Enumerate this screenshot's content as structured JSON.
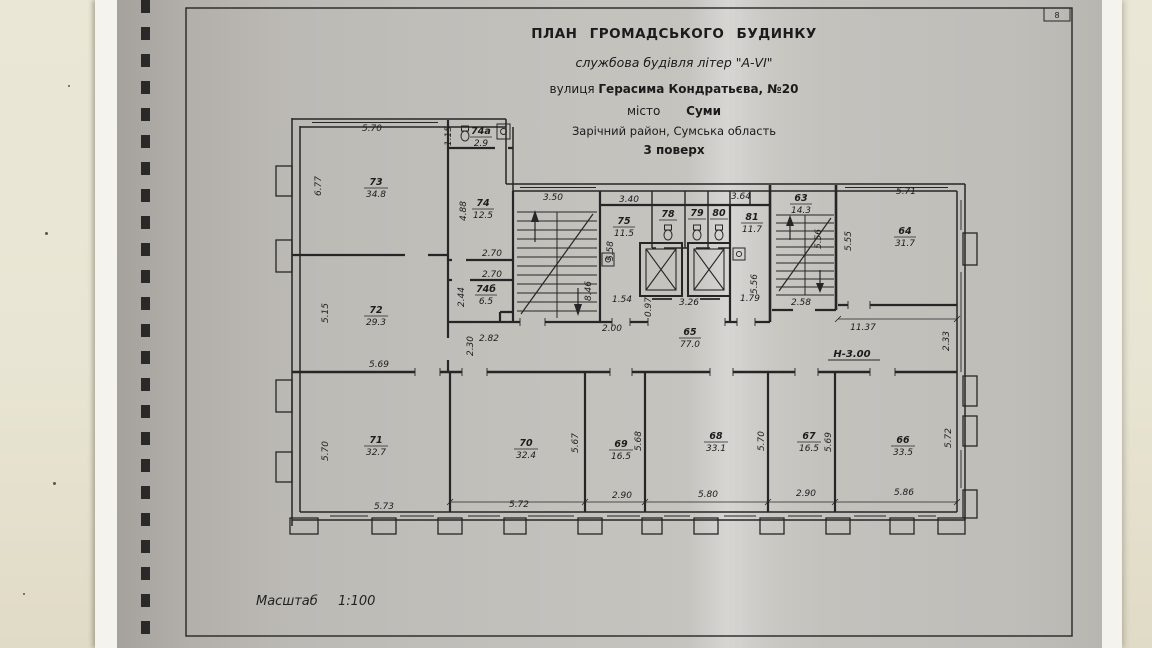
{
  "page": {
    "corner_number": "8"
  },
  "title_block": {
    "line1": "ПЛАН ГРОМАДСЬКОГО БУДИНКУ",
    "line2": "службова будівля літер \"А-VI\"",
    "line3_label": "вулиця",
    "line3_value": "Герасима Кондратьєва, №20",
    "line4_label": "місто",
    "line4_value": "Суми",
    "line5": "Зарічний район, Сумська область",
    "line6": "3 поверх"
  },
  "scale_note": {
    "label": "Масштаб",
    "value": "1:100"
  },
  "plan": {
    "height_mark": "Н-3.00",
    "rooms": [
      {
        "num": "73",
        "area": "34.8"
      },
      {
        "num": "74а",
        "area": "2.9"
      },
      {
        "num": "74",
        "area": "12.5"
      },
      {
        "num": "74б",
        "area": "6.5"
      },
      {
        "num": "72",
        "area": "29.3"
      },
      {
        "num": "75",
        "area": "11.5"
      },
      {
        "num": "78",
        "area": ""
      },
      {
        "num": "79",
        "area": ""
      },
      {
        "num": "80",
        "area": ""
      },
      {
        "num": "81",
        "area": "11.7"
      },
      {
        "num": "63",
        "area": "14.3"
      },
      {
        "num": "64",
        "area": "31.7"
      },
      {
        "num": "65",
        "area": "77.0"
      },
      {
        "num": "71",
        "area": "32.7"
      },
      {
        "num": "70",
        "area": "32.4"
      },
      {
        "num": "69",
        "area": "16.5"
      },
      {
        "num": "68",
        "area": "33.1"
      },
      {
        "num": "67",
        "area": "16.5"
      },
      {
        "num": "66",
        "area": "33.5"
      }
    ],
    "dims": [
      "5.70",
      "1.15",
      "6.77",
      "4.88",
      "2.70",
      "2.70",
      "2.44",
      "2.82",
      "5.15",
      "2.30",
      "3.50",
      "8.46",
      "3.40",
      "5.58",
      "1.54",
      "0.97",
      "3.26",
      "3.64",
      "1.79",
      "5.56",
      "5.56",
      "2.58",
      "5.55",
      "5.71",
      "2.00",
      "11.37",
      "2.33",
      "5.69",
      "5.70",
      "5.73",
      "5.72",
      "5.67",
      "5.68",
      "2.90",
      "5.80",
      "5.70",
      "2.90",
      "5.69",
      "5.86",
      "5.72"
    ]
  }
}
